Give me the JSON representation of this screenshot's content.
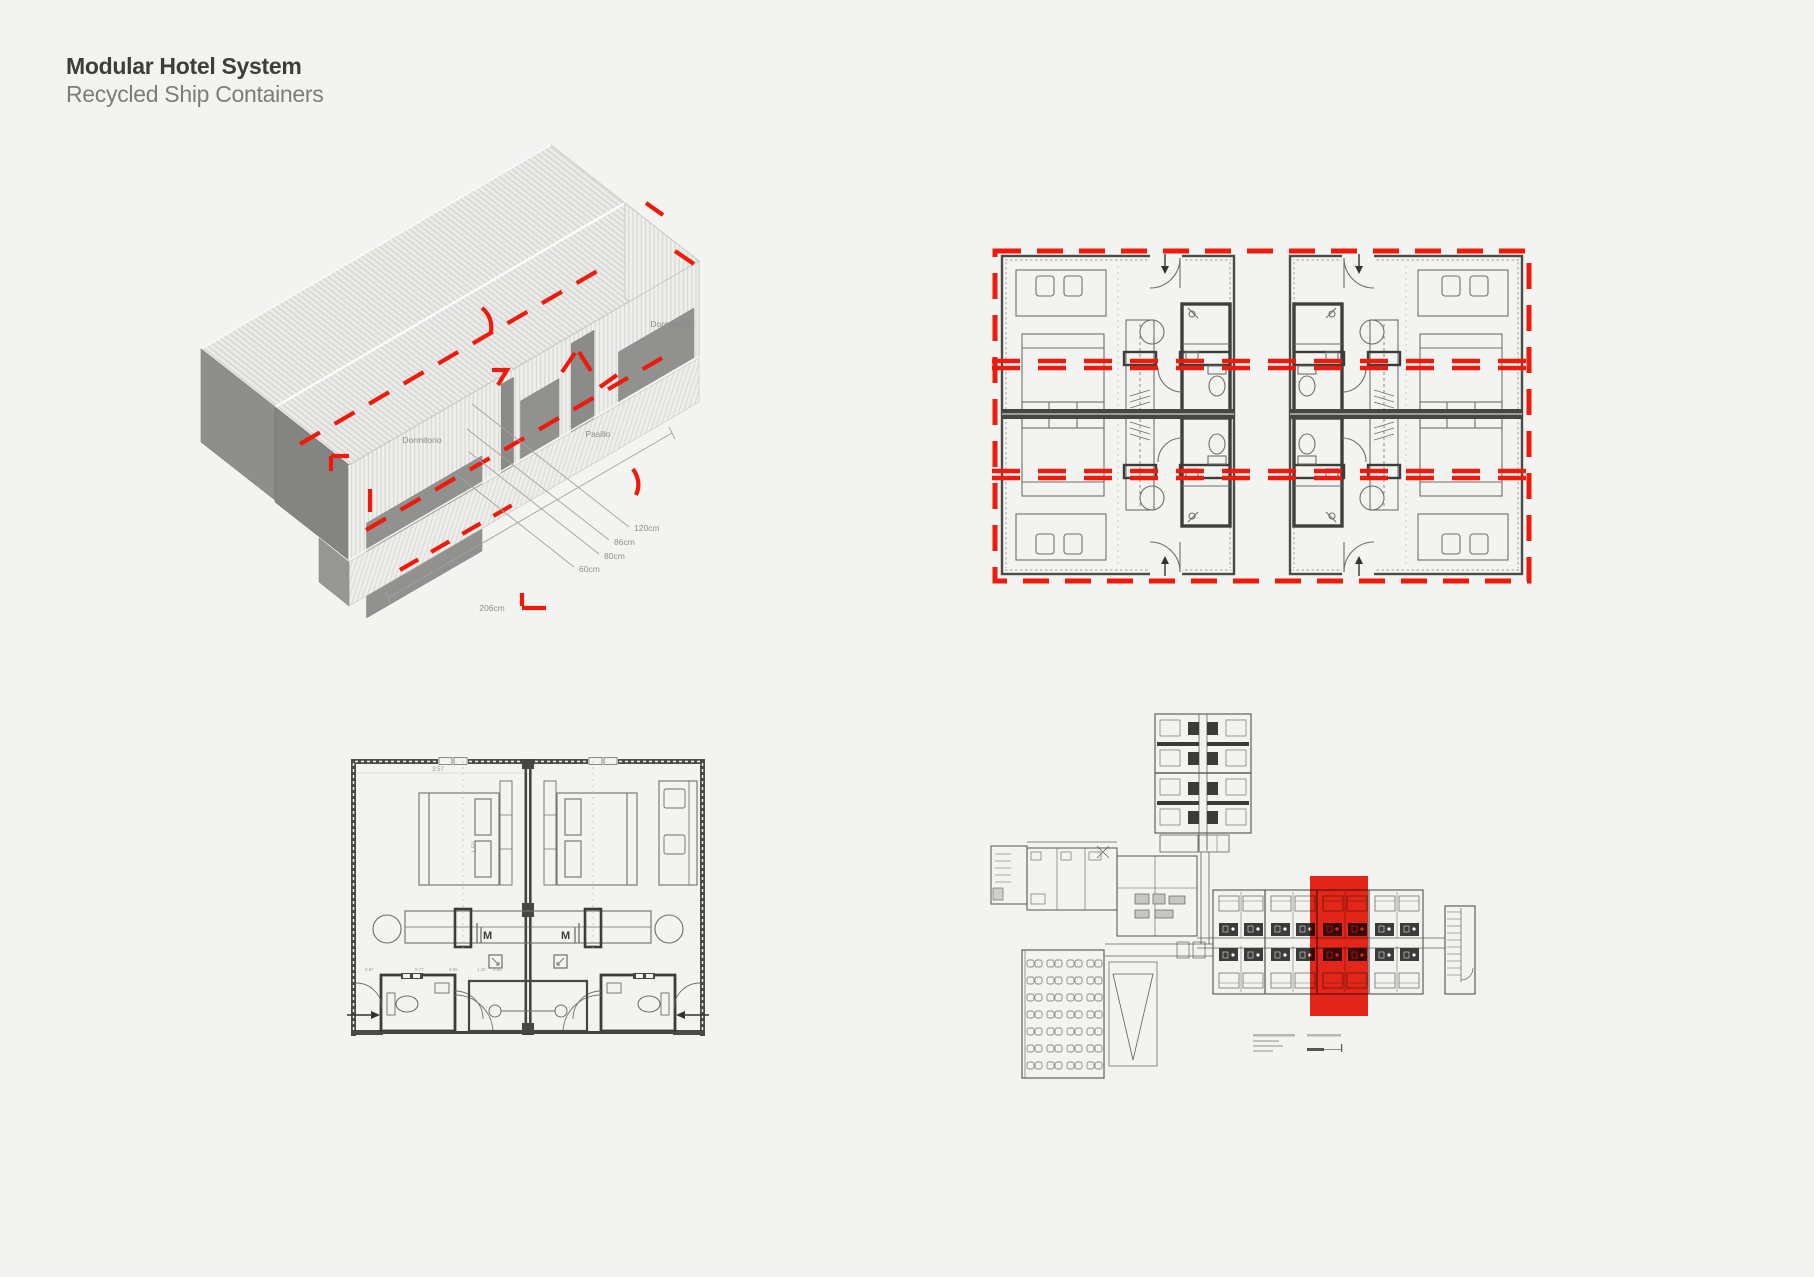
{
  "header": {
    "title": "Modular Hotel System",
    "subtitle": "Recycled Ship Containers"
  },
  "colors": {
    "background": "#f3f3f1",
    "accent_red": "#ee1b0d",
    "wall_dark": "#454543",
    "panel_gray": "#919190",
    "ink": "#3d3d3b",
    "label_gray": "#8b8b89"
  },
  "iso_view": {
    "labels": {
      "room_left": "Dormitorio",
      "corridor": "Pasillo",
      "room_right": "Dormitorio"
    },
    "dimensions": {
      "w1": "120cm",
      "w2": "86cm",
      "w3": "80cm",
      "w4": "60cm",
      "length_total": "206cm"
    }
  },
  "room_plan": {
    "labels": {
      "minibar_left": "M",
      "minibar_right": "M"
    },
    "dimensions": {
      "width": "3.57",
      "bed": "1.50",
      "row": [
        "0.87",
        "0.77",
        "0.85",
        "1.20",
        "0.85"
      ]
    }
  }
}
